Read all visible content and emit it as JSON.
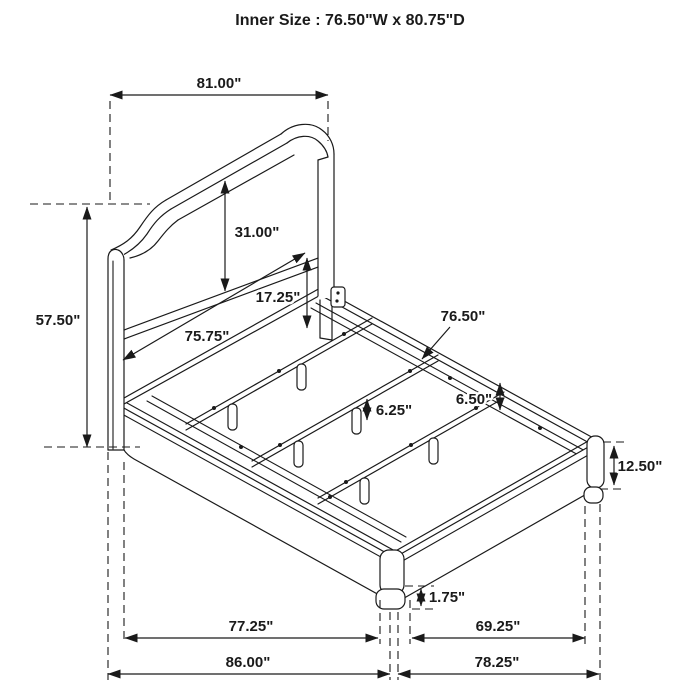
{
  "title": "Inner Size : 76.50\"W x 80.75\"D",
  "dims": {
    "headboard_width": "81.00\"",
    "headboard_height": "57.50\"",
    "panel_height": "31.00\"",
    "rail_height": "17.25\"",
    "inner_rail_length": "75.75\"",
    "slat_length": "76.50\"",
    "rail_gap": "6.50\"",
    "leg_height": "6.25\"",
    "footboard_height": "12.50\"",
    "foot_height": "1.75\"",
    "frame_depth": "77.25\"",
    "overall_depth": "86.00\"",
    "footboard_inner_width": "69.25\"",
    "footboard_width": "78.25\""
  },
  "colors": {
    "line": "#1a1a1a",
    "background": "#ffffff"
  }
}
